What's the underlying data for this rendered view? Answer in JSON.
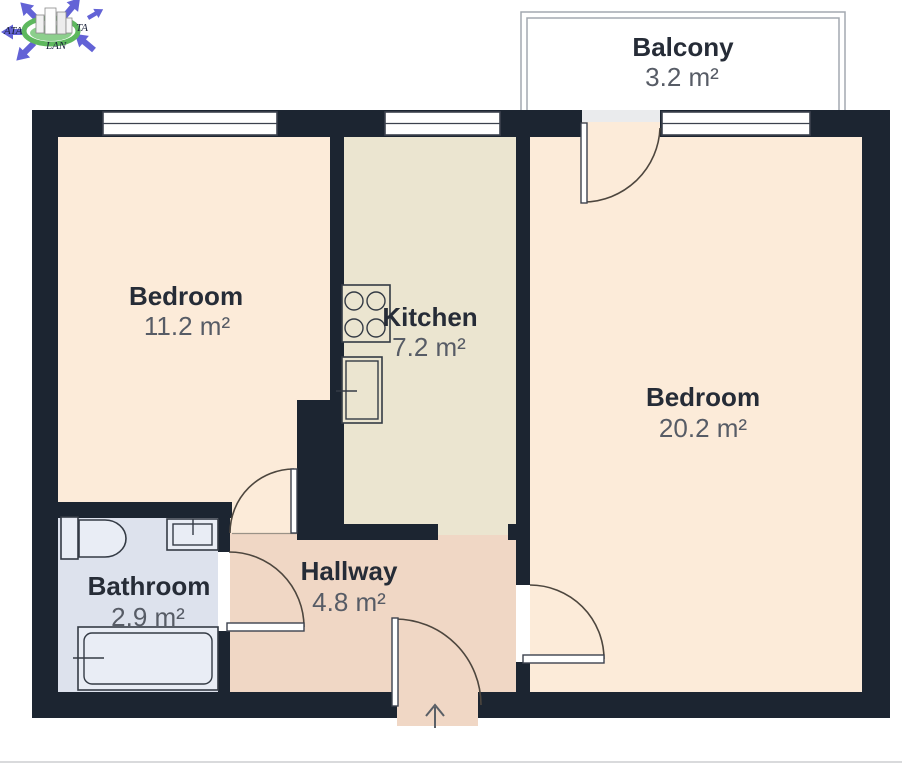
{
  "page": {
    "type": "apartment-floor-plan"
  },
  "logo": {
    "text_left": "ATA",
    "text_right": "TA",
    "text_bottom": "LAN"
  },
  "rooms": {
    "balcony": {
      "name": "Balcony",
      "area": "3.2 m²"
    },
    "bedroom_left": {
      "name": "Bedroom",
      "area": "11.2 m²"
    },
    "kitchen": {
      "name": "Kitchen",
      "area": "7.2 m²"
    },
    "bedroom_right": {
      "name": "Bedroom",
      "area": "20.2 m²"
    },
    "bathroom": {
      "name": "Bathroom",
      "area": "2.9 m²"
    },
    "hallway": {
      "name": "Hallway",
      "area": "4.8 m²"
    }
  },
  "fixtures": [
    "stove-icon",
    "kitchen-sink-icon",
    "toilet-icon",
    "bathroom-sink-icon",
    "bathtub-icon",
    "entry-arrow-icon"
  ],
  "colors": {
    "wall": "#1c2531",
    "bedroom_floor": "#fcebd9",
    "kitchen_floor": "#ebe5d0",
    "hallway_floor": "#f0d7c5",
    "bathroom_floor": "#dde2ed",
    "balcony_floor": "#eaebed",
    "room_name_text": "#262c37",
    "room_area_text": "#575c66",
    "door_arc": "#4d463e",
    "logo_blue": "#6363d6",
    "logo_green": "#5eb85e"
  }
}
